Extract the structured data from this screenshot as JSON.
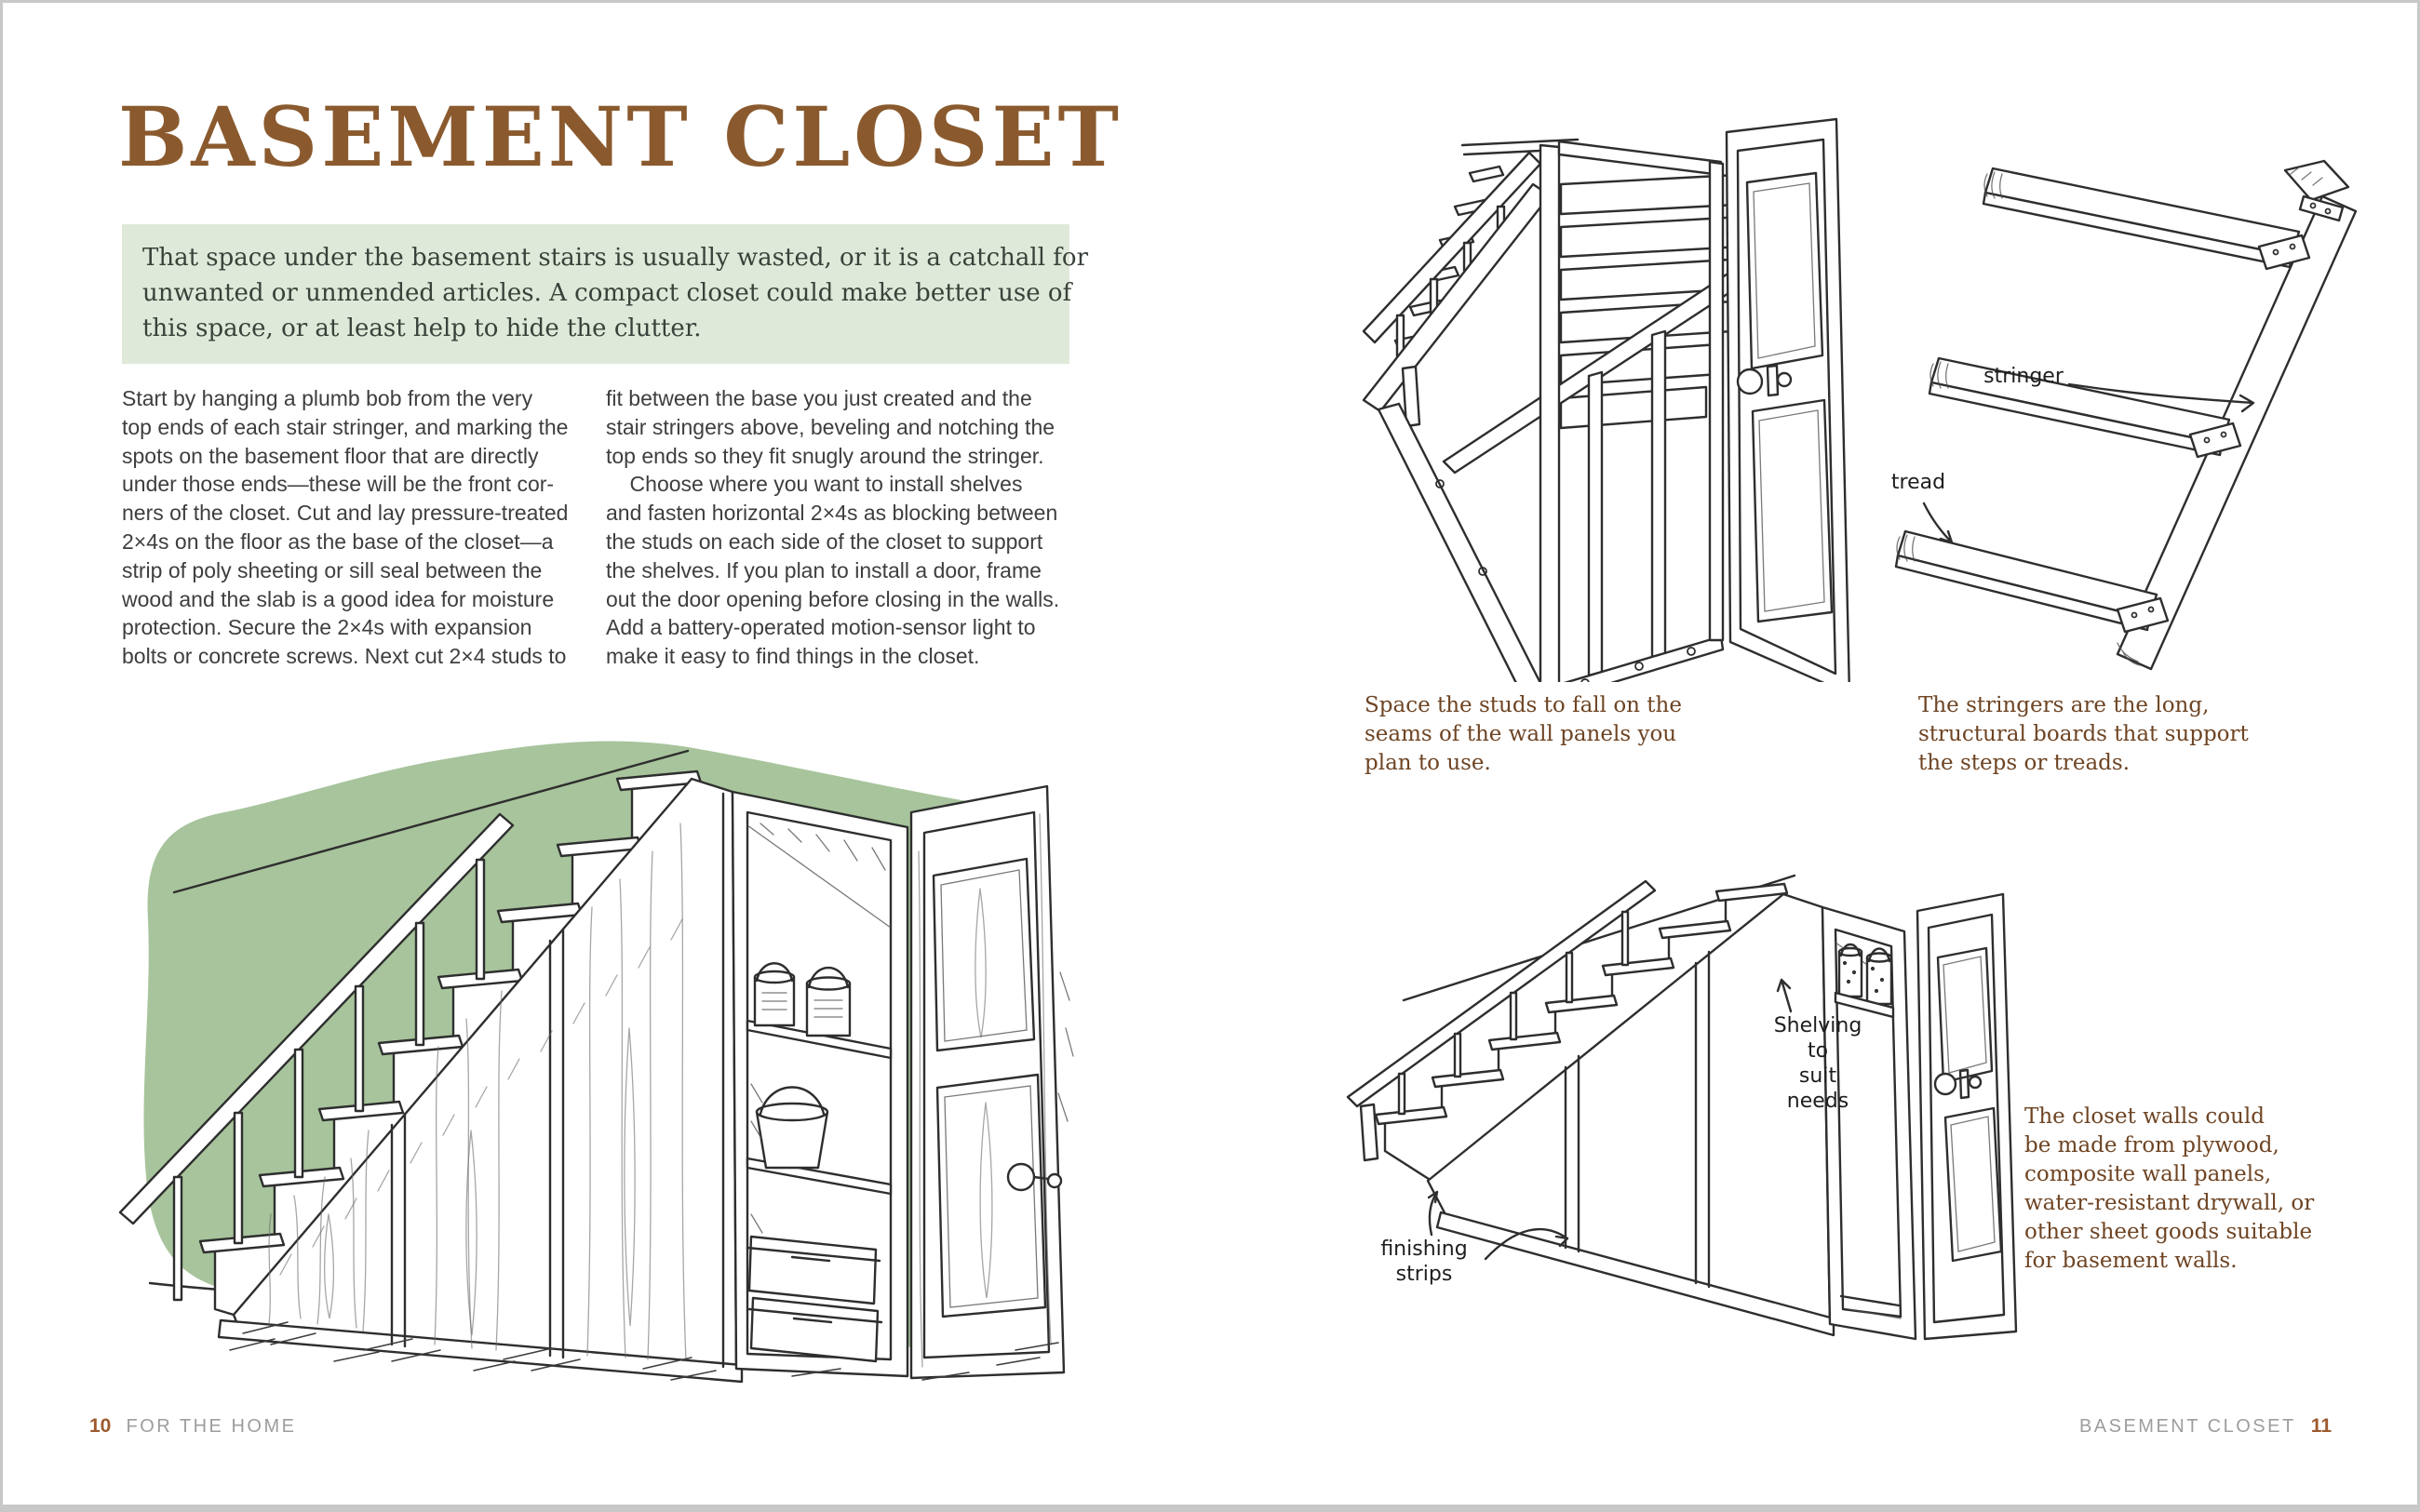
{
  "left_page": {
    "title": "BASEMENT CLOSET",
    "intro": "That space under the basement stairs is usually wasted, or it is a catchall for\nunwanted or unmended articles. A compact closet could make better use of\nthis space, or at least help to hide the clutter.",
    "body_col1": "Start by hanging a plumb bob from the very\ntop ends of each stair stringer, and marking the\nspots on the basement floor that are directly\nunder those ends—these will be the front cor-\nners of the closet. Cut and lay pressure-treated\n2×4s on the floor as the base of the closet—a\nstrip of poly sheeting or sill seal between the\nwood and the slab is a good idea for moisture\nprotection. Secure the 2×4s with expansion\nbolts or concrete screws. Next cut 2×4 studs to",
    "body_col2": "fit between the base you just created and the\nstair stringers above, beveling and notching the\ntop ends so they fit snugly around the stringer.\n    Choose where you want to install shelves\nand fasten horizontal 2×4s as blocking between\nthe studs on each side of the closet to support\nthe shelves. If you plan to install a door, frame\nout the door opening before closing in the walls.\nAdd a battery-operated motion-sensor light to\nmake it easy to find things in the closet.",
    "footer": {
      "page_number": "10",
      "section": "FOR THE HOME"
    }
  },
  "right_page": {
    "captions": {
      "studs": "Space the studs to fall on the\nseams of the wall panels you\nplan to use.",
      "stringers": "The stringers are the long,\nstructural boards that support\nthe steps or treads.",
      "walls": "The closet walls could\nbe made from plywood,\ncomposite wall panels,\nwater-resistant drywall, or\nother sheet goods suitable\nfor basement walls."
    },
    "labels": {
      "stringer": "stringer",
      "tread": "tread",
      "shelving": "Shelving\nto\nsuit\nneeds",
      "finishing": "finishing\nstrips"
    },
    "footer": {
      "section": "BASEMENT CLOSET",
      "page_number": "11"
    }
  },
  "colors": {
    "title_brown": "#8a5a2e",
    "caption_brown": "#6e4423",
    "intro_bg": "#dfe9d9",
    "intro_text": "#39413a",
    "wall_green": "#a7c49c",
    "body_text": "#3e3e3e",
    "footer_gray": "#9d9d9d",
    "page_number_brown": "#9c5a2e",
    "line_ink": "#2e2e2e"
  }
}
